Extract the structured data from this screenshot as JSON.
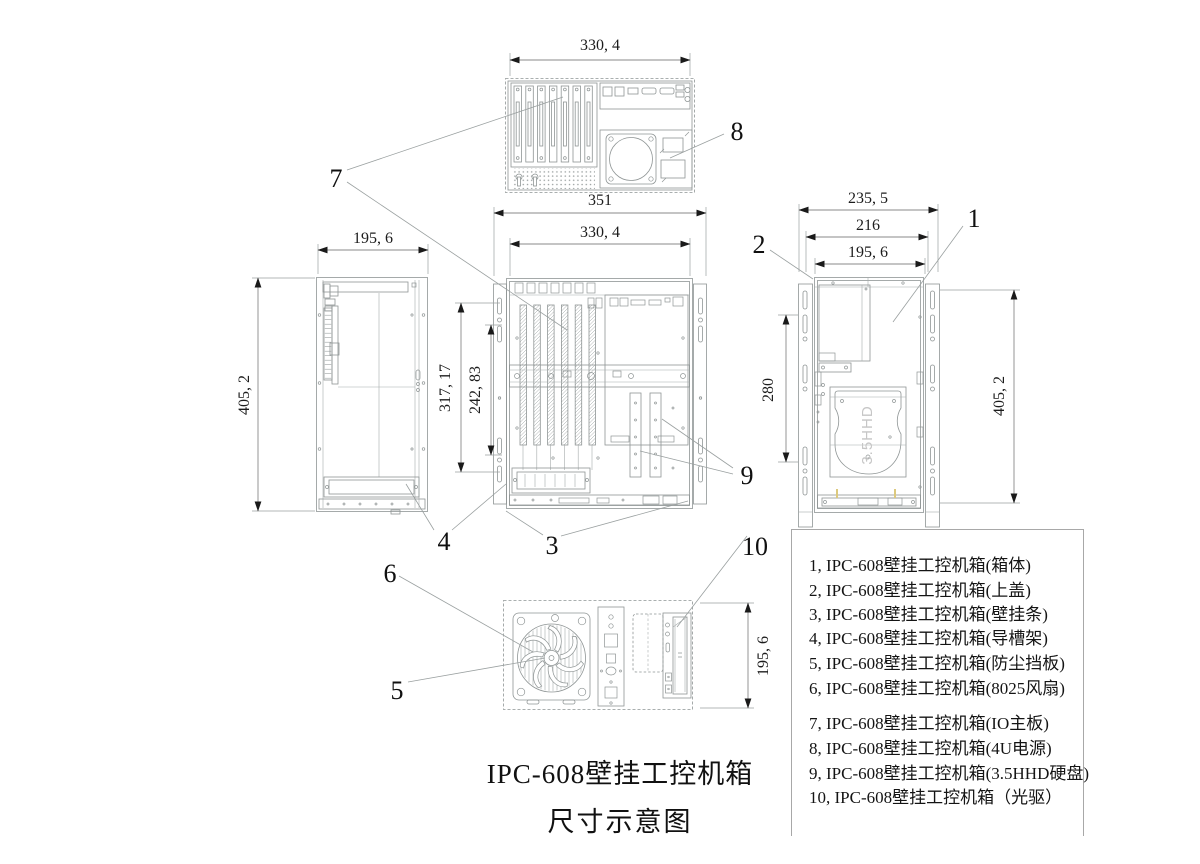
{
  "drawing_title": {
    "line1": "IPC-608壁挂工控机箱",
    "line2": "尺寸示意图"
  },
  "dimensions": {
    "top_view_width": "330, 4",
    "front_view_outer_width": "351",
    "front_view_width": "330, 4",
    "left_view_width": "195, 6",
    "left_view_height": "405, 2",
    "front_inner_height_a": "317, 17",
    "front_inner_height_b": "242, 83",
    "right_view_outer_width": "235, 5",
    "right_view_mid_width": "216",
    "right_view_width": "195, 6",
    "right_inner_height": "280",
    "right_view_height": "405, 2",
    "bottom_view_depth": "195, 6"
  },
  "callouts": {
    "c1": "1",
    "c2": "2",
    "c3": "3",
    "c4": "4",
    "c5": "5",
    "c6": "6",
    "c7": "7",
    "c8": "8",
    "c9": "9",
    "c10": "10"
  },
  "part_labels": {
    "hdd": "3.5HHD"
  },
  "legend": {
    "items": [
      "1, IPC-608壁挂工控机箱(箱体)",
      "2, IPC-608壁挂工控机箱(上盖)",
      "3, IPC-608壁挂工控机箱(壁挂条)",
      "4, IPC-608壁挂工控机箱(导槽架)",
      "5, IPC-608壁挂工控机箱(防尘挡板)",
      "6, IPC-608壁挂工控机箱(8025风扇)",
      "7, IPC-608壁挂工控机箱(IO主板)",
      "8, IPC-608壁挂工控机箱(4U电源)",
      "9, IPC-608壁挂工控机箱(3.5HHD硬盘)",
      "10, IPC-608壁挂工控机箱（光驱）"
    ]
  },
  "colors": {
    "background": "#ffffff",
    "drawing_line": "#8f9595",
    "dimension_line": "#8a8a8a",
    "text": "#141414",
    "hdd_label": "#c6c6c6",
    "accent_tick": "#dcc97e"
  }
}
